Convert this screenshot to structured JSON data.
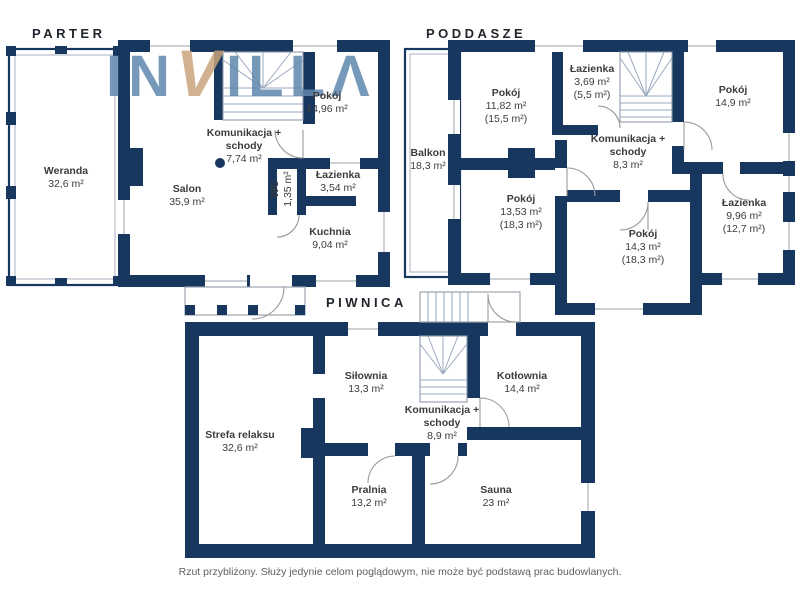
{
  "watermark": {
    "part1": "IN",
    "part2": "V",
    "part3": "ILL",
    "part4": "Λ"
  },
  "colors": {
    "wall": "#17375e",
    "logo_blue": "#5f87ad",
    "logo_tan": "#c9a47c",
    "label_text": "#3c3c3c",
    "title_text": "#20242c"
  },
  "floors": [
    {
      "id": "parter",
      "title": "PARTER",
      "rooms": [
        {
          "name": "Weranda",
          "area": "32,6 m²"
        },
        {
          "name": "Salon",
          "area": "35,9 m²"
        },
        {
          "name": "Pokój",
          "area": "14,96 m²"
        },
        {
          "name": "Komunikacja + schody",
          "area": "7,74 m²"
        },
        {
          "name": "WC",
          "area": "1,35 m²"
        },
        {
          "name": "Łazienka",
          "area": "3,54 m²"
        },
        {
          "name": "Kuchnia",
          "area": "9,04 m²"
        }
      ]
    },
    {
      "id": "poddasze",
      "title": "PODDASZE",
      "rooms": [
        {
          "name": "Balkon",
          "area": "18,3 m²"
        },
        {
          "name": "Pokój",
          "area": "11,82 m²",
          "area2": "(15,5 m²)"
        },
        {
          "name": "Łazienka",
          "area": "3,69 m²",
          "area2": "(5,5 m²)"
        },
        {
          "name": "Pokój",
          "area": "14,9 m²"
        },
        {
          "name": "Komunikacja + schody",
          "area": "8,3 m²"
        },
        {
          "name": "Pokój",
          "area": "13,53 m²",
          "area2": "(18,3 m²)"
        },
        {
          "name": "Pokój",
          "area": "14,3 m²",
          "area2": "(18,3 m²)"
        },
        {
          "name": "Łazienka",
          "area": "9,96 m²",
          "area2": "(12,7 m²)"
        }
      ]
    },
    {
      "id": "piwnica",
      "title": "PIWNICA",
      "rooms": [
        {
          "name": "Strefa relaksu",
          "area": "32,6 m²"
        },
        {
          "name": "Siłownia",
          "area": "13,3 m²"
        },
        {
          "name": "Kotłownia",
          "area": "14,4 m²"
        },
        {
          "name": "Komunikacja + schody",
          "area": "8,9 m²"
        },
        {
          "name": "Pralnia",
          "area": "13,2 m²"
        },
        {
          "name": "Sauna",
          "area": "23 m²"
        }
      ]
    }
  ],
  "footer": {
    "disclaimer": "Rzut przybliżony. Służy jedynie celom poglądowym, nie może być podstawą prac budowlanych."
  }
}
